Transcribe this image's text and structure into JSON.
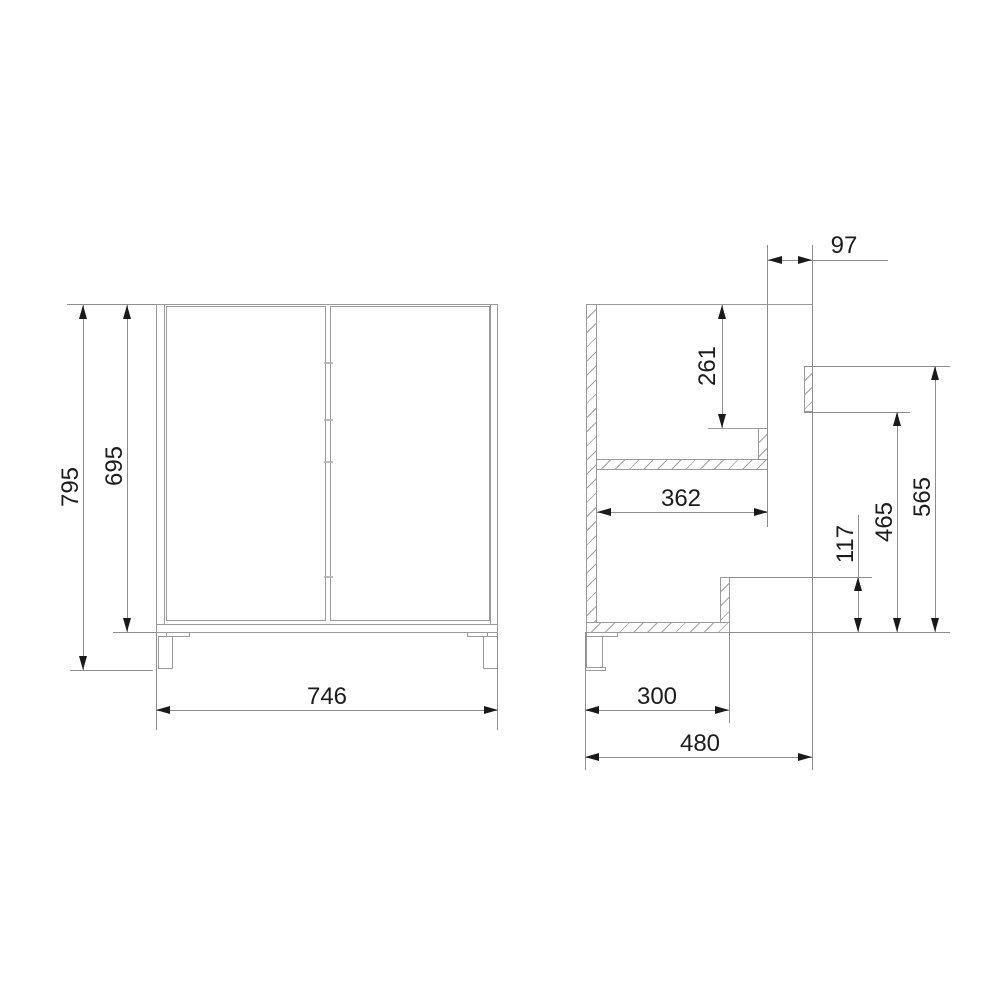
{
  "drawing": {
    "kind": "technical_dimension_drawing",
    "subject": "two-door cabinet (front view and side section view)",
    "units": "mm",
    "background_color": "#ffffff",
    "line_color": "#9a9a9a",
    "dimension_text_color": "#1c1c1c",
    "front_view": {
      "label": "front view",
      "dims": {
        "overall_height": "795",
        "carcass_height": "695",
        "width": "746"
      }
    },
    "side_view": {
      "label": "side section view",
      "dims": {
        "back_clearance": "97",
        "top_to_shelf_support": "261",
        "shelf_depth": "362",
        "back_rail_top_height": "565",
        "back_rail_bottom_height": "465",
        "back_cutout_height": "117",
        "lower_body_depth": "300",
        "overall_depth": "480"
      }
    }
  }
}
